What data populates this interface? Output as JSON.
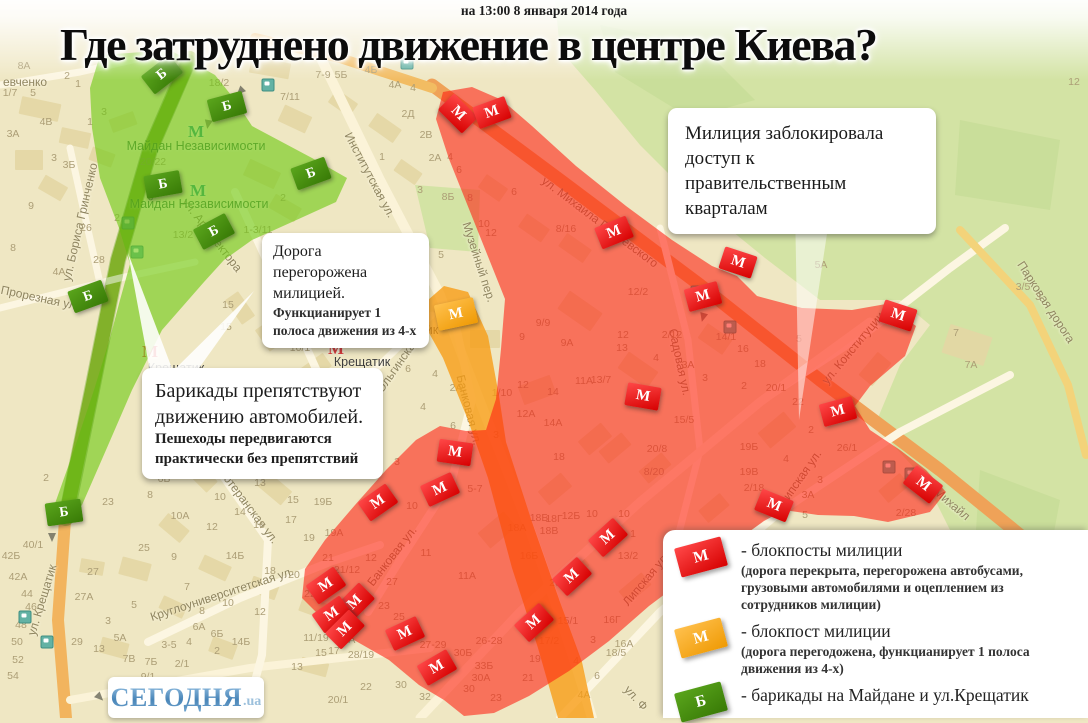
{
  "header": {
    "timestamp": "на 13:00 8 января 2014 года",
    "title": "Где затруднено движение в центре Киева?"
  },
  "callouts": {
    "police": {
      "line1": "Милиция заблокировала доступ к правительственным кварталам"
    },
    "road": {
      "line1": "Дорога перегорожена милицией.",
      "line2": "Функцианирует 1 полоса движения из 4-х"
    },
    "barricades": {
      "line1": "Барикады препятствуют движению автомобилей.",
      "line2": "Пешеходы передвигаются практически без препятствий"
    }
  },
  "legend": {
    "items": [
      {
        "symbol": "М",
        "color_top": "#ff4848",
        "color_bottom": "#d60000",
        "label": "- блокпосты милиции",
        "sub": "(дорога перекрыта, перегорожена автобусами, грузовыми автомобилями и оцеплением из сотрудников милиции)"
      },
      {
        "symbol": "М",
        "color_top": "#ffc04d",
        "color_bottom": "#ef9a04",
        "label": "- блокпост милиции",
        "sub": "(дорога перегодожена, функцианирует 1 полоса движения из 4-х)"
      },
      {
        "symbol": "Б",
        "color_top": "#5aa51c",
        "color_bottom": "#387a06",
        "label": "- барикады на Майдане и ул.Крещатик",
        "sub": ""
      }
    ]
  },
  "logo": {
    "text": "СЕГОДНЯ",
    "suffix": ".ua"
  },
  "colors": {
    "zone_red": "#FF1E0F",
    "zone_orange": "#F79B12",
    "zone_green": "#6FC913",
    "marker_red": "#d60000",
    "marker_orange": "#ef9a04",
    "marker_green": "#387a06"
  },
  "map": {
    "symbols": {
      "police": "М",
      "orange": "М",
      "barricade": "Б"
    },
    "checkpoints_police": [
      [
        458,
        114,
        45
      ],
      [
        492,
        113,
        -20
      ],
      [
        614,
        233,
        -22
      ],
      [
        738,
        263,
        18
      ],
      [
        703,
        297,
        -15
      ],
      [
        643,
        397,
        10
      ],
      [
        898,
        316,
        18
      ],
      [
        838,
        412,
        -15
      ],
      [
        923,
        485,
        38
      ],
      [
        774,
        506,
        22
      ],
      [
        455,
        453,
        8
      ],
      [
        440,
        490,
        -25
      ],
      [
        378,
        503,
        -35
      ],
      [
        326,
        586,
        -35
      ],
      [
        355,
        603,
        -45
      ],
      [
        332,
        615,
        -35
      ],
      [
        345,
        630,
        -45
      ],
      [
        405,
        634,
        -25
      ],
      [
        437,
        668,
        -30
      ],
      [
        608,
        538,
        -42
      ],
      [
        572,
        577,
        -42
      ],
      [
        534,
        623,
        -42
      ]
    ],
    "checkpoints_orange": [
      [
        456,
        314,
        -12
      ]
    ],
    "barricades": [
      [
        162,
        75,
        -38
      ],
      [
        227,
        107,
        -15
      ],
      [
        163,
        185,
        -10
      ],
      [
        311,
        174,
        -20
      ],
      [
        214,
        232,
        -28
      ],
      [
        88,
        297,
        -20
      ],
      [
        64,
        513,
        -8
      ]
    ],
    "metro": [
      {
        "name": "Майдан Независимости",
        "icon": [
          196,
          132
        ],
        "label": [
          196,
          146
        ],
        "style": "green"
      },
      {
        "name": "Майдан Независимости",
        "icon": [
          198,
          191
        ],
        "label": [
          199,
          204
        ],
        "style": "green"
      },
      {
        "name": "Крещатик",
        "icon": [
          404,
          312
        ],
        "label": [
          410,
          330
        ],
        "style": "red"
      },
      {
        "name": "Крещатик",
        "icon": [
          336,
          349
        ],
        "label": [
          362,
          362
        ],
        "style": "red"
      },
      {
        "name": "Крещатик",
        "icon": [
          150,
          352
        ],
        "label": [
          176,
          368
        ],
        "style": "red"
      }
    ],
    "street_labels": [
      [
        "ул. Михаила Грушевского",
        600,
        222,
        37
      ],
      [
        "Музейный пер.",
        479,
        262,
        72
      ],
      [
        "Садовая ул.",
        680,
        362,
        78
      ],
      [
        "ул. Конституции",
        853,
        348,
        -50
      ],
      [
        "Липская ул.",
        800,
        478,
        -55
      ],
      [
        "Липская ул.",
        646,
        579,
        -50
      ],
      [
        "Банковая ул.",
        469,
        410,
        76
      ],
      [
        "Банковая ул.",
        392,
        556,
        -52
      ],
      [
        "Ольгинская ул.",
        403,
        357,
        -55
      ],
      [
        "Институтская ул.",
        370,
        175,
        62
      ],
      [
        "ул. Архитектора",
        212,
        235,
        52
      ],
      [
        "ул. Бориса Гринченко",
        80,
        222,
        -77
      ],
      [
        "евченко",
        25,
        82,
        0
      ],
      [
        "Прорезная ул.",
        40,
        298,
        12
      ],
      [
        "ул. Крещатик",
        42,
        600,
        -73
      ],
      [
        "Лютеранская ул.",
        248,
        505,
        53
      ],
      [
        "Круглоуниверситетская ул.",
        222,
        594,
        -18
      ],
      [
        "Парковая дорога",
        1046,
        302,
        57
      ],
      [
        "Михайл",
        952,
        504,
        40
      ],
      [
        "ул. Ф",
        636,
        698,
        48
      ]
    ],
    "numbers": [
      [
        "8А",
        24,
        66
      ],
      [
        "1/7",
        10,
        93
      ],
      [
        "5",
        33,
        93
      ],
      [
        "2",
        67,
        76
      ],
      [
        "1",
        78,
        84
      ],
      [
        "3",
        104,
        112
      ],
      [
        "4В",
        46,
        122
      ],
      [
        "1",
        90,
        122
      ],
      [
        "3А",
        13,
        134
      ],
      [
        "3",
        54,
        158
      ],
      [
        "3Б",
        69,
        165
      ],
      [
        "9",
        31,
        206
      ],
      [
        "26",
        86,
        228
      ],
      [
        "8",
        13,
        248
      ],
      [
        "28",
        99,
        260
      ],
      [
        "4А",
        59,
        272
      ],
      [
        "20/22",
        153,
        162
      ],
      [
        "13/2",
        183,
        235
      ],
      [
        "2",
        117,
        218
      ],
      [
        "1-3/11",
        258,
        230
      ],
      [
        "2",
        283,
        198
      ],
      [
        "18/2",
        219,
        83
      ],
      [
        "7/11",
        290,
        97
      ],
      [
        "7-9",
        323,
        75
      ],
      [
        "5Б",
        341,
        75
      ],
      [
        "4Б",
        371,
        70
      ],
      [
        "4А",
        395,
        85
      ],
      [
        "4",
        413,
        88
      ],
      [
        "2Д",
        408,
        114
      ],
      [
        "2В",
        426,
        135
      ],
      [
        "1",
        382,
        157
      ],
      [
        "2А",
        435,
        158
      ],
      [
        "4",
        450,
        157
      ],
      [
        "6",
        459,
        170
      ],
      [
        "3",
        420,
        190
      ],
      [
        "8Б",
        448,
        197
      ],
      [
        "8",
        470,
        198
      ],
      [
        "10",
        484,
        224
      ],
      [
        "12",
        491,
        233
      ],
      [
        "5",
        441,
        255
      ],
      [
        "12",
        1074,
        82
      ],
      [
        "15",
        228,
        305
      ],
      [
        "8",
        281,
        306
      ],
      [
        "9",
        308,
        306
      ],
      [
        "2",
        267,
        320
      ],
      [
        "15",
        226,
        327
      ],
      [
        "11Б",
        337,
        316
      ],
      [
        "11В",
        364,
        316
      ],
      [
        "11А",
        329,
        330
      ],
      [
        "13",
        360,
        340
      ],
      [
        "4",
        273,
        345
      ],
      [
        "10/1",
        300,
        348
      ],
      [
        "6",
        408,
        369
      ],
      [
        "4",
        435,
        374
      ],
      [
        "2А",
        456,
        388
      ],
      [
        "4",
        423,
        407
      ],
      [
        "3",
        397,
        462
      ],
      [
        "6",
        453,
        426
      ],
      [
        "5",
        318,
        463
      ],
      [
        "6",
        514,
        192
      ],
      [
        "8/16",
        566,
        229
      ],
      [
        "12/2",
        638,
        292
      ],
      [
        "9/9",
        543,
        323
      ],
      [
        "9",
        522,
        337
      ],
      [
        "9А",
        567,
        343
      ],
      [
        "11А",
        584,
        381
      ],
      [
        "13/7",
        601,
        380
      ],
      [
        "12",
        523,
        385
      ],
      [
        "14",
        553,
        392
      ],
      [
        "1/10",
        502,
        393
      ],
      [
        "12А",
        526,
        414
      ],
      [
        "14А",
        553,
        423
      ],
      [
        "3",
        496,
        435
      ],
      [
        "18",
        559,
        457
      ],
      [
        "12",
        623,
        335
      ],
      [
        "13",
        622,
        348
      ],
      [
        "2/12",
        672,
        335
      ],
      [
        "4",
        656,
        358
      ],
      [
        "3А",
        688,
        365
      ],
      [
        "3",
        705,
        378
      ],
      [
        "14/1",
        726,
        337
      ],
      [
        "16",
        743,
        349
      ],
      [
        "18",
        760,
        364
      ],
      [
        "2",
        744,
        386
      ],
      [
        "20/1",
        776,
        388
      ],
      [
        "22",
        798,
        402
      ],
      [
        "2",
        811,
        430
      ],
      [
        "5",
        799,
        339
      ],
      [
        "5А",
        821,
        265
      ],
      [
        "15/5",
        684,
        420
      ],
      [
        "16Б",
        529,
        556
      ],
      [
        "18А",
        517,
        528
      ],
      [
        "18Б",
        539,
        518
      ],
      [
        "18Г",
        554,
        519
      ],
      [
        "12Б",
        571,
        516
      ],
      [
        "18В",
        549,
        531
      ],
      [
        "10",
        592,
        514
      ],
      [
        "20",
        555,
        583
      ],
      [
        "26/1",
        847,
        448
      ],
      [
        "19Б",
        749,
        447
      ],
      [
        "4",
        786,
        459
      ],
      [
        "19В",
        749,
        472
      ],
      [
        "3",
        820,
        480
      ],
      [
        "3А",
        808,
        495
      ],
      [
        "2/18",
        754,
        488
      ],
      [
        "5",
        805,
        515
      ],
      [
        "5-7",
        475,
        489
      ],
      [
        "10",
        412,
        506
      ],
      [
        "11",
        426,
        553
      ],
      [
        "11А",
        467,
        576
      ],
      [
        "12",
        371,
        558
      ],
      [
        "27",
        392,
        582
      ],
      [
        "23",
        384,
        606
      ],
      [
        "25",
        399,
        617
      ],
      [
        "27-29",
        433,
        645
      ],
      [
        "26-28",
        489,
        641
      ],
      [
        "30Б",
        463,
        653
      ],
      [
        "33Б",
        484,
        666
      ],
      [
        "30А",
        481,
        678
      ],
      [
        "19Б",
        323,
        502
      ],
      [
        "15",
        293,
        500
      ],
      [
        "17",
        291,
        520
      ],
      [
        "19А",
        334,
        533
      ],
      [
        "19",
        309,
        538
      ],
      [
        "21",
        328,
        558
      ],
      [
        "21/12",
        347,
        570
      ],
      [
        "20",
        294,
        575
      ],
      [
        "22",
        310,
        594
      ],
      [
        "11/19",
        316,
        638
      ],
      [
        "28А",
        346,
        640
      ],
      [
        "28/19",
        361,
        655
      ],
      [
        "13",
        297,
        667
      ],
      [
        "15",
        321,
        653
      ],
      [
        "17",
        334,
        651
      ],
      [
        "30",
        401,
        685
      ],
      [
        "32",
        425,
        697
      ],
      [
        "22",
        366,
        687
      ],
      [
        "20/1",
        338,
        700
      ],
      [
        "30",
        469,
        689
      ],
      [
        "23",
        496,
        698
      ],
      [
        "2",
        46,
        478
      ],
      [
        "23",
        108,
        502
      ],
      [
        "40/1",
        33,
        545
      ],
      [
        "42Б",
        11,
        556
      ],
      [
        "42А",
        18,
        577
      ],
      [
        "44",
        27,
        594
      ],
      [
        "46",
        31,
        607
      ],
      [
        "48",
        21,
        625
      ],
      [
        "50",
        17,
        642
      ],
      [
        "52",
        18,
        660
      ],
      [
        "54",
        13,
        676
      ],
      [
        "29",
        77,
        642
      ],
      [
        "27",
        93,
        572
      ],
      [
        "27А",
        84,
        597
      ],
      [
        "5А",
        120,
        638
      ],
      [
        "13",
        99,
        649
      ],
      [
        "3",
        108,
        621
      ],
      [
        "5",
        134,
        605
      ],
      [
        "7В",
        129,
        659
      ],
      [
        "7Б",
        151,
        662
      ],
      [
        "9/1",
        148,
        677
      ],
      [
        "2/1",
        182,
        664
      ],
      [
        "3-5",
        169,
        645
      ],
      [
        "4",
        189,
        642
      ],
      [
        "6А",
        199,
        627
      ],
      [
        "6Б",
        217,
        634
      ],
      [
        "2",
        217,
        651
      ],
      [
        "14Б",
        241,
        642
      ],
      [
        "8",
        202,
        611
      ],
      [
        "10",
        228,
        603
      ],
      [
        "12",
        260,
        612
      ],
      [
        "7",
        187,
        587
      ],
      [
        "6Б",
        164,
        479
      ],
      [
        "8",
        150,
        495
      ],
      [
        "10А",
        180,
        516
      ],
      [
        "10",
        220,
        497
      ],
      [
        "9/9",
        229,
        461
      ],
      [
        "11",
        246,
        472
      ],
      [
        "13",
        260,
        483
      ],
      [
        "14",
        240,
        512
      ],
      [
        "12",
        212,
        527
      ],
      [
        "16",
        259,
        525
      ],
      [
        "14Б",
        235,
        556
      ],
      [
        "9",
        174,
        557
      ],
      [
        "25",
        144,
        548
      ],
      [
        "18",
        270,
        571
      ],
      [
        "15/1",
        568,
        621
      ],
      [
        "16Г",
        612,
        620
      ],
      [
        "17/2",
        549,
        641
      ],
      [
        "3",
        593,
        640
      ],
      [
        "16А",
        624,
        644
      ],
      [
        "18/5",
        616,
        653
      ],
      [
        "19",
        535,
        659
      ],
      [
        "4",
        576,
        661
      ],
      [
        "21",
        528,
        678
      ],
      [
        "6",
        597,
        676
      ],
      [
        "4А",
        584,
        695
      ],
      [
        "13/2",
        628,
        556
      ],
      [
        "1",
        633,
        534
      ],
      [
        "10",
        624,
        514
      ],
      [
        "20/8",
        657,
        449
      ],
      [
        "8/20",
        654,
        472
      ],
      [
        "2/28",
        906,
        513
      ],
      [
        "3/5",
        1023,
        287
      ],
      [
        "3",
        1038,
        297
      ],
      [
        "7",
        956,
        333
      ],
      [
        "7А",
        971,
        365
      ]
    ],
    "transit_stops": [
      [
        268,
        85
      ],
      [
        407,
        63
      ],
      [
        128,
        223
      ],
      [
        137,
        252
      ],
      [
        697,
        292
      ],
      [
        730,
        327
      ],
      [
        889,
        467
      ],
      [
        911,
        474
      ],
      [
        25,
        617
      ],
      [
        47,
        642
      ]
    ],
    "arrows": [
      [
        240,
        92,
        225
      ],
      [
        208,
        125,
        190
      ],
      [
        52,
        538,
        180
      ],
      [
        100,
        698,
        135
      ],
      [
        703,
        318,
        195
      ]
    ]
  }
}
